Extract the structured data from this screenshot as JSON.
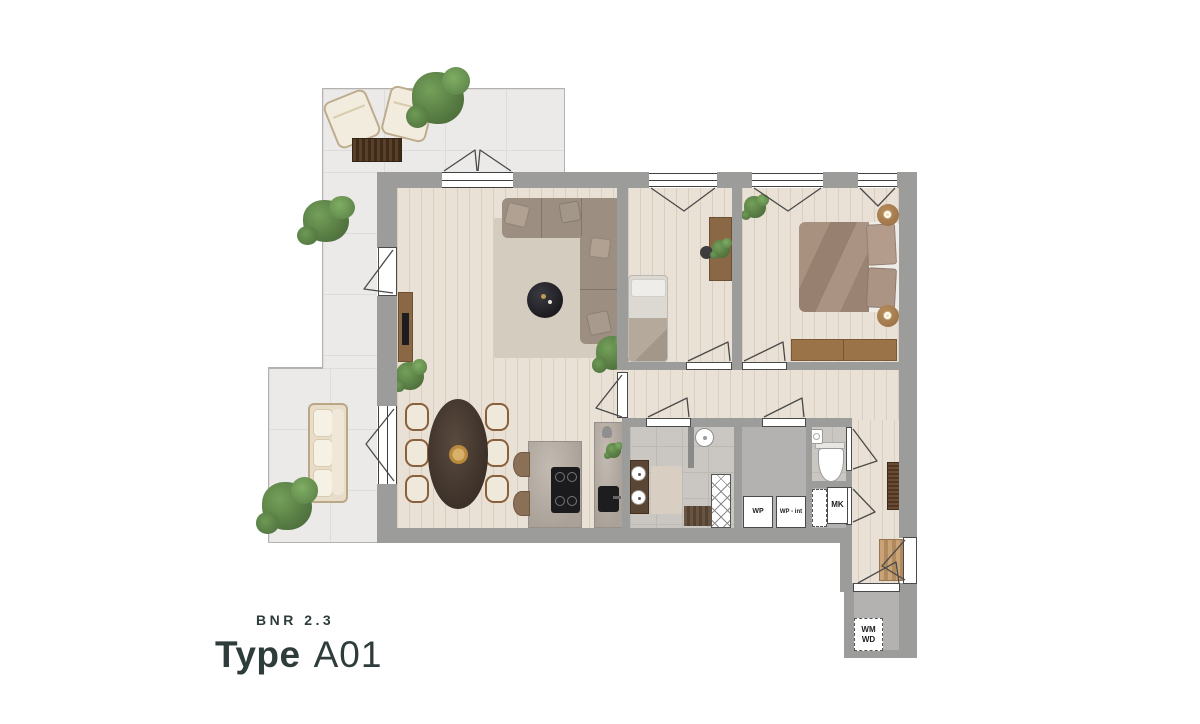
{
  "title": {
    "bnr": "BNR 2.3",
    "type_label": "Type",
    "type_code": "A01"
  },
  "labels": {
    "wp": "WP",
    "wp_int": "WP - int",
    "mk": "MK",
    "wm": "WM",
    "wd": "WD"
  },
  "colors": {
    "wall": "#9c9c9a",
    "wood_floor": "#e9e1d5",
    "terrace_tile": "#eceae8",
    "bath_tile": "#cac7c3",
    "concrete": "#b4b2b0",
    "title_text": "#2e3c3c",
    "sofa": "#9c8f81",
    "rug": "#d4ccbe",
    "bed_duvet": "#a28a7c",
    "wood_furniture": "#8b6845",
    "plant": "#5c7f48"
  }
}
